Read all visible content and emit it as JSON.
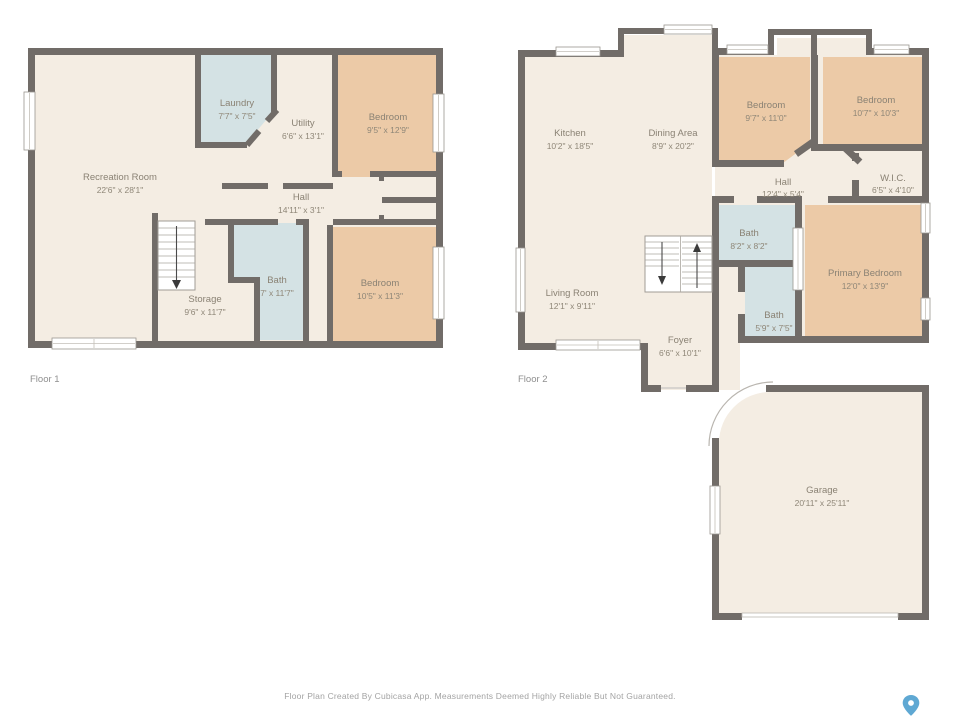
{
  "page": {
    "footer_disclaimer": "Floor Plan Created By Cubicasa App. Measurements Deemed Highly Reliable But Not Guaranteed.",
    "brand_icon": "map-pin-icon"
  },
  "colors": {
    "wall": "#716c68",
    "floor": "#f4ede3",
    "bedroom_fill": "#eccaa7",
    "wet_room_fill": "#d4e2e4",
    "room_label": "#8a8274",
    "caption": "#8f8f8f",
    "disclaimer": "#a3a3a3",
    "pin": "#5fa8d3"
  },
  "floor1": {
    "label": "Floor 1",
    "rooms": [
      {
        "name": "Recreation Room",
        "dims": "22'6\" x 28'1\""
      },
      {
        "name": "Laundry",
        "dims": "7'7\" x 7'5\""
      },
      {
        "name": "Utility",
        "dims": "6'6\" x 13'1\""
      },
      {
        "name": "Bedroom",
        "dims": "9'5\" x 12'9\""
      },
      {
        "name": "Hall",
        "dims": "14'11\" x 3'1\""
      },
      {
        "name": "Bath",
        "dims": "7' x 11'7\""
      },
      {
        "name": "Storage",
        "dims": "9'6\" x 11'7\""
      },
      {
        "name": "Bedroom",
        "dims": "10'5\" x 11'3\""
      }
    ]
  },
  "floor2": {
    "label": "Floor 2",
    "rooms": [
      {
        "name": "Kitchen",
        "dims": "10'2\" x 18'5\""
      },
      {
        "name": "Dining Area",
        "dims": "8'9\" x 20'2\""
      },
      {
        "name": "Bedroom",
        "dims": "9'7\" x 11'0\""
      },
      {
        "name": "Bedroom",
        "dims": "10'7\" x 10'3\""
      },
      {
        "name": "Hall",
        "dims": "12'4\" x 5'4\""
      },
      {
        "name": "W.I.C.",
        "dims": "6'5\" x 4'10\""
      },
      {
        "name": "Bath",
        "dims": "8'2\" x 8'2\""
      },
      {
        "name": "Primary Bedroom",
        "dims": "12'0\" x 13'9\""
      },
      {
        "name": "Living Room",
        "dims": "12'1\" x 9'11\""
      },
      {
        "name": "Bath",
        "dims": "5'9\" x 7'5\""
      },
      {
        "name": "Foyer",
        "dims": "6'6\" x 10'1\""
      },
      {
        "name": "Garage",
        "dims": "20'11\" x 25'11\""
      }
    ]
  }
}
